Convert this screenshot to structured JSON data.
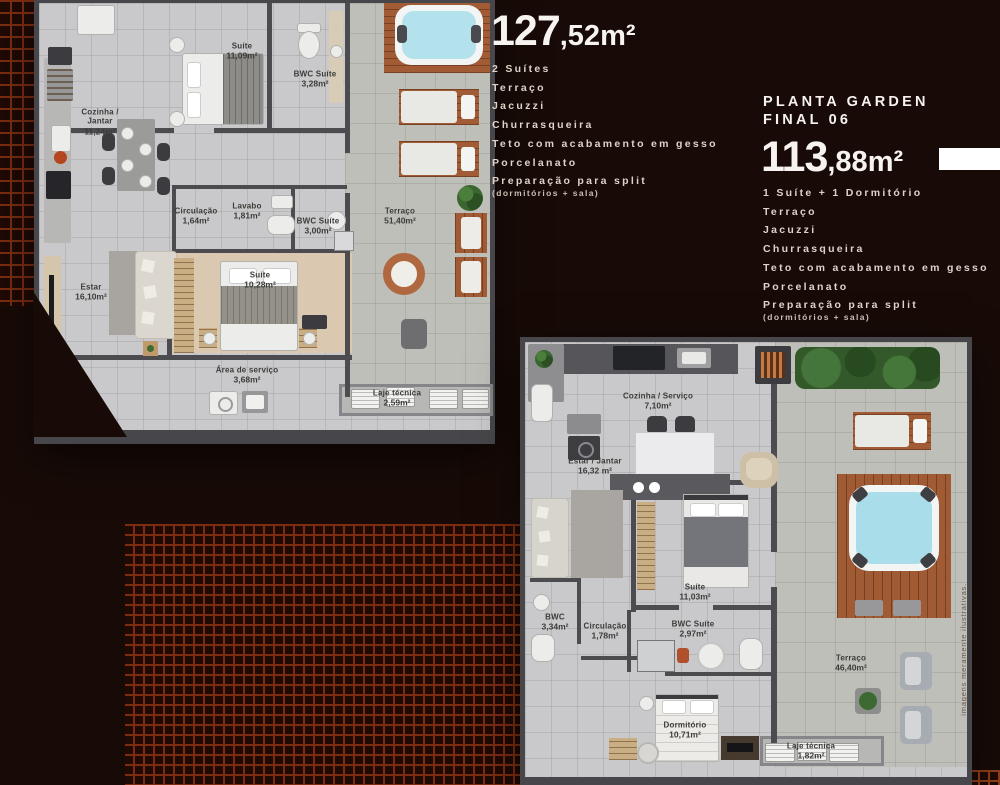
{
  "colors": {
    "background": "#180b07",
    "brick_accent": "#7c2d11",
    "accent_bar": "#ffffff"
  },
  "watermark": "imagens meramente ilustrativas.",
  "unit_top": {
    "final_label": "FINAL 05",
    "area_big": "127",
    "area_small": ",52m²",
    "features": [
      "2 Suítes",
      "Terraço",
      "Jacuzzi",
      "Churrasqueira",
      "Teto com acabamento em gesso",
      "Porcelanato",
      "Preparação para split"
    ],
    "features_note": "(dormitórios + sala)"
  },
  "unit_right": {
    "title_line1": "PLANTA GARDEN",
    "title_line2": "FINAL 06",
    "area_big": "113",
    "area_small": ",88m²",
    "features": [
      "1 Suíte + 1 Dormitório",
      "Terraço",
      "Jacuzzi",
      "Churrasqueira",
      "Teto com acabamento em gesso",
      "Porcelanato",
      "Preparação para split"
    ],
    "features_note": "(dormitórios + sala)"
  },
  "plan1": {
    "rooms": [
      {
        "name": "Suíte",
        "area": "11,09m²"
      },
      {
        "name": "BWC Suíte",
        "area": "3,28m²"
      },
      {
        "name": "Cozinha / Jantar",
        "area": "11,24m²"
      },
      {
        "name": "Circulação",
        "area": "1,64m²"
      },
      {
        "name": "Lavabo",
        "area": "1,81m²"
      },
      {
        "name": "BWC Suíte",
        "area": "3,00m²"
      },
      {
        "name": "Terraço",
        "area": "51,40m²"
      },
      {
        "name": "Estar",
        "area": "16,10m²"
      },
      {
        "name": "Suíte",
        "area": "10,28m²"
      },
      {
        "name": "Área de serviço",
        "area": "3,68m²"
      },
      {
        "name": "Laje técnica",
        "area": "2,59m²"
      }
    ]
  },
  "plan2": {
    "rooms": [
      {
        "name": "Cozinha / Serviço",
        "area": "7,10m²"
      },
      {
        "name": "Estar / Jantar",
        "area": "16,32 m²"
      },
      {
        "name": "Suíte",
        "area": "11,03m²"
      },
      {
        "name": "BWC",
        "area": "3,34m²"
      },
      {
        "name": "Circulação",
        "area": "1,78m²"
      },
      {
        "name": "BWC Suíte",
        "area": "2,97m²"
      },
      {
        "name": "Dormitório",
        "area": "10,71m²"
      },
      {
        "name": "Terraço",
        "area": "46,40m²"
      },
      {
        "name": "Laje técnica",
        "area": "1,82m²"
      }
    ]
  }
}
